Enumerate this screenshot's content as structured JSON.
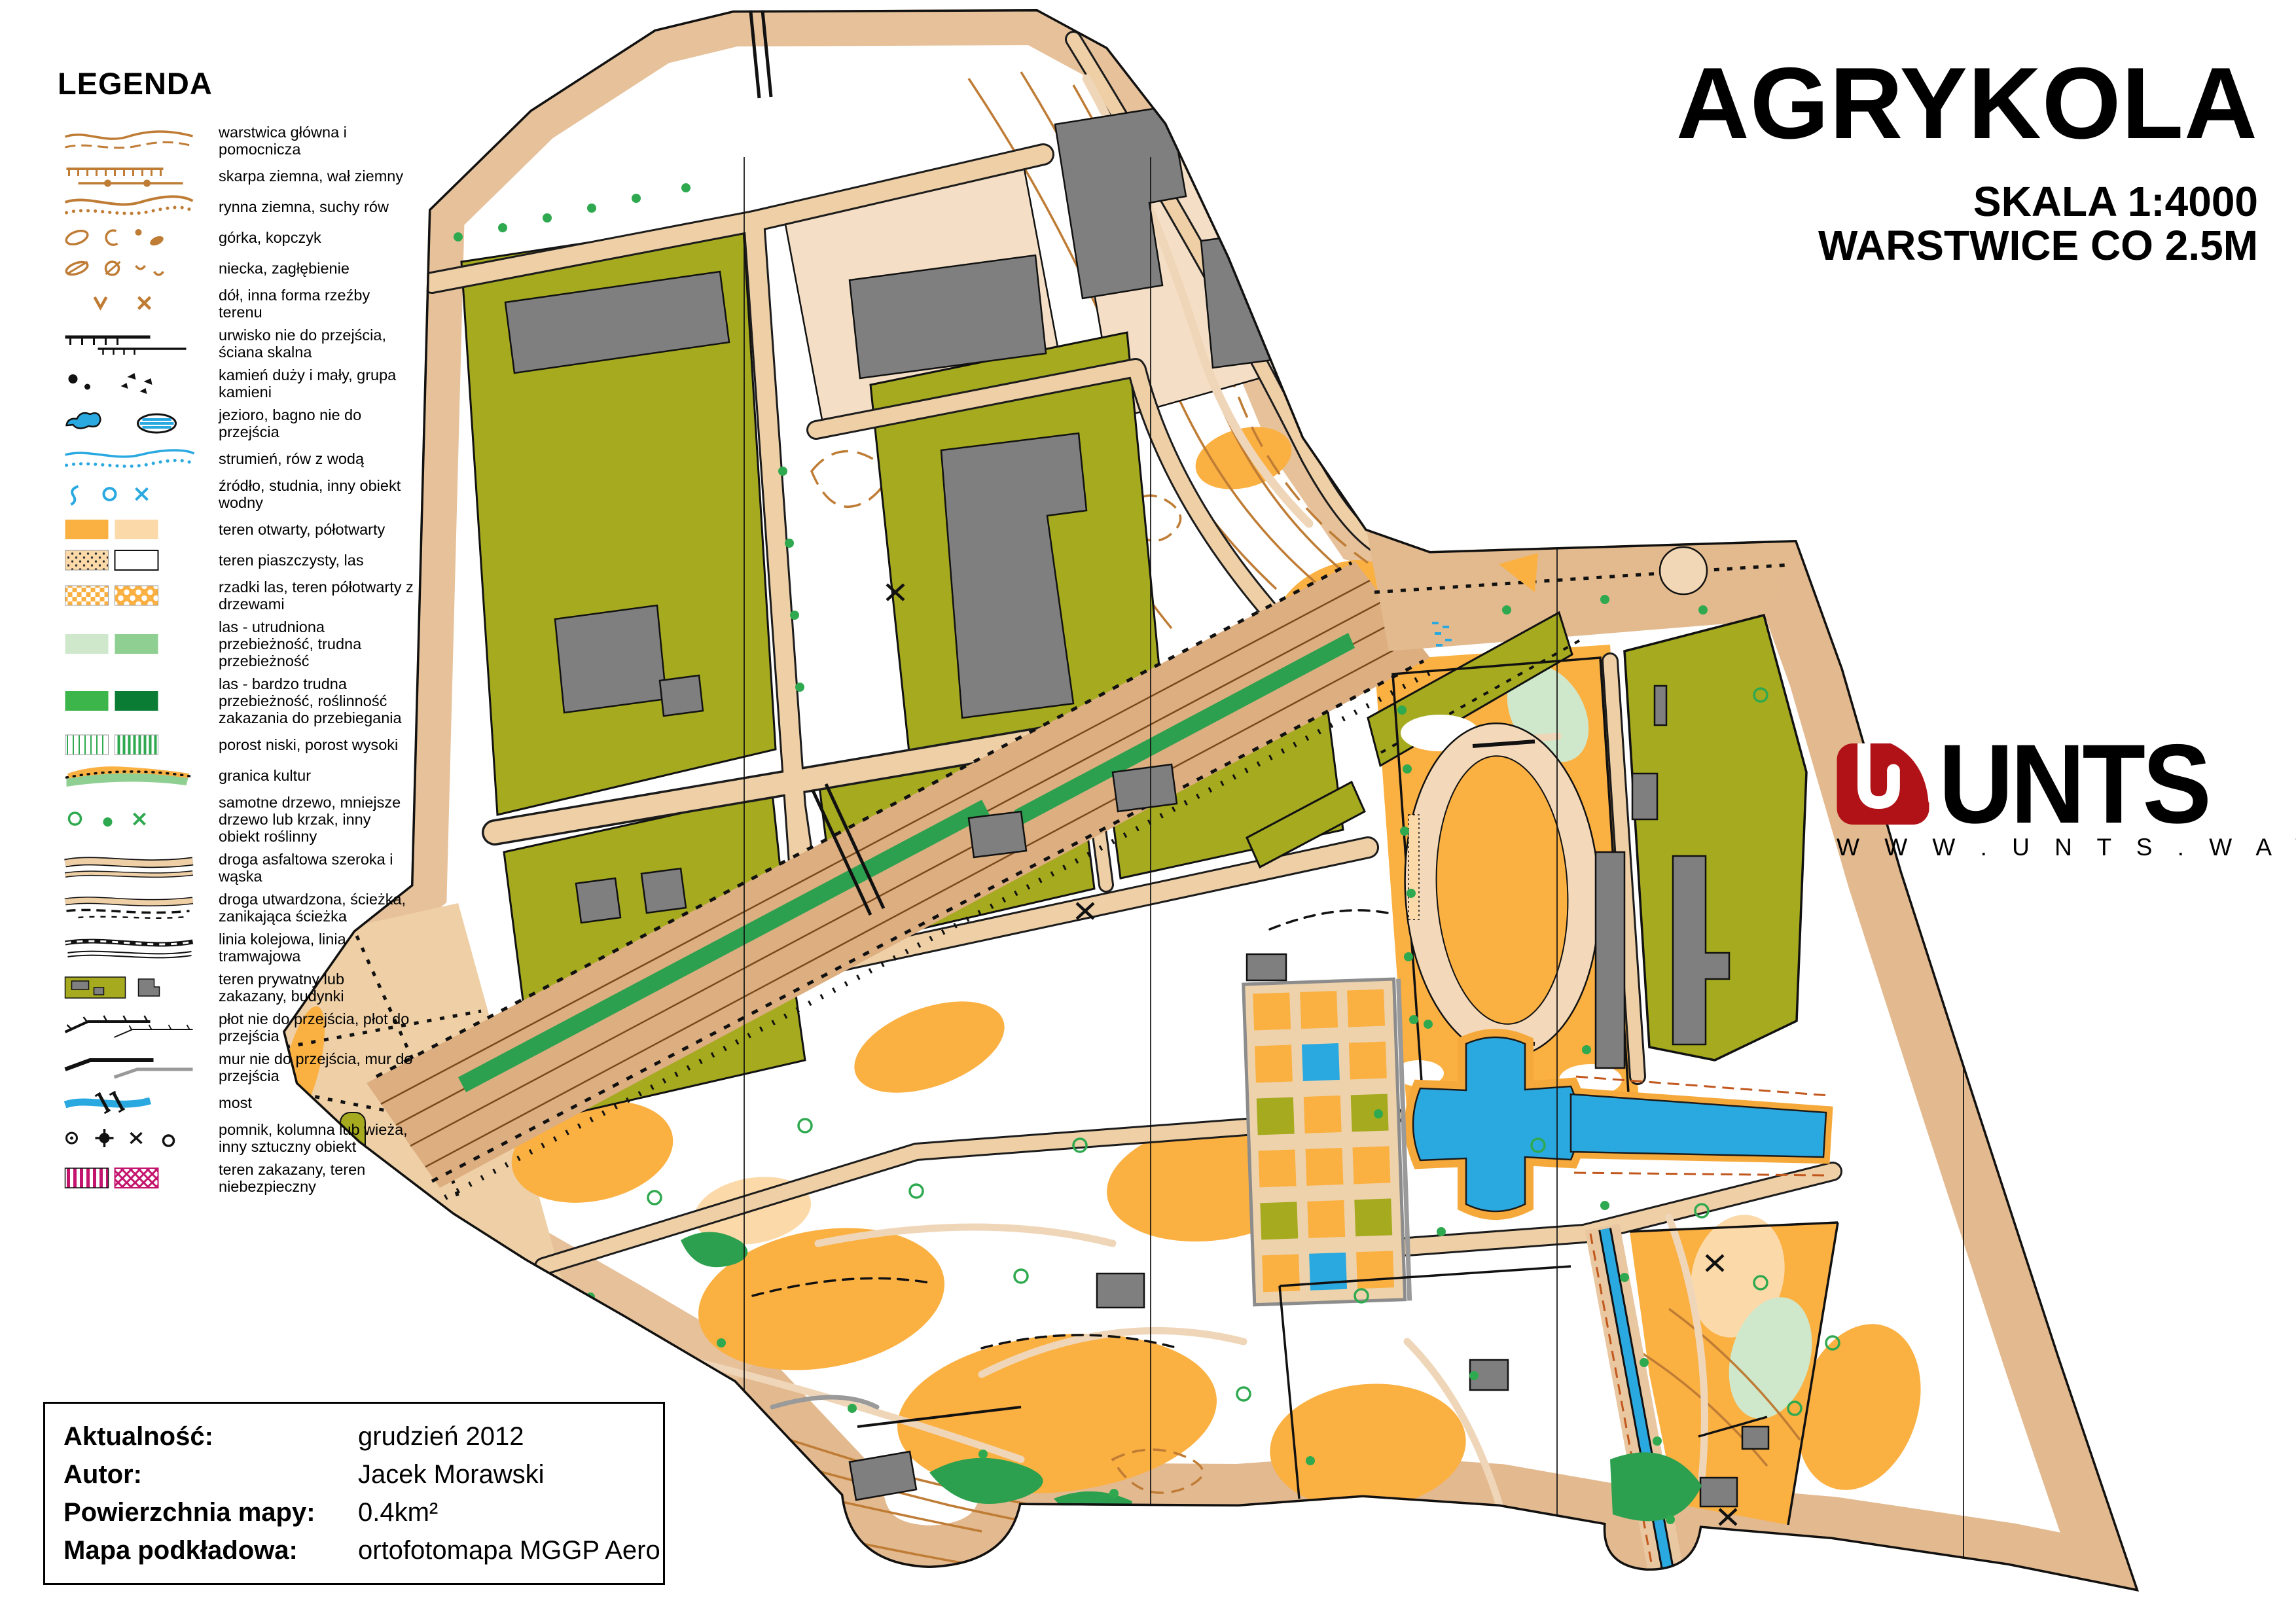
{
  "legend": {
    "title": "LEGENDA",
    "items": [
      {
        "symbol": "contours",
        "label": "warstwica główna i pomocnicza"
      },
      {
        "symbol": "earth-bank",
        "label": "skarpa ziemna, wał ziemny"
      },
      {
        "symbol": "dry-ditch",
        "label": "rynna ziemna, suchy rów"
      },
      {
        "symbol": "knoll",
        "label": "górka, kopczyk"
      },
      {
        "symbol": "depression",
        "label": "niecka, zagłębienie"
      },
      {
        "symbol": "pit",
        "label": "dół, inna forma rzeźby terenu"
      },
      {
        "symbol": "cliff",
        "label": "urwisko nie do przejścia, ściana skalna"
      },
      {
        "symbol": "stones",
        "label": "kamień duży i mały, grupa kamieni"
      },
      {
        "symbol": "lake-marsh",
        "label": "jezioro, bagno nie do przejścia"
      },
      {
        "symbol": "stream",
        "label": "strumień, rów z wodą"
      },
      {
        "symbol": "spring",
        "label": "źródło, studnia, inny obiekt wodny"
      },
      {
        "symbol": "open-land",
        "label": "teren otwarty, półotwarty"
      },
      {
        "symbol": "sand-forest",
        "label": "teren piaszczysty, las"
      },
      {
        "symbol": "rough-open",
        "label": "rzadki las, teren półotwarty z drzewami"
      },
      {
        "symbol": "forest-walk",
        "label": "las - utrudniona przebieżność, trudna przebieżność"
      },
      {
        "symbol": "forest-fight",
        "label": "las - bardzo trudna przebieżność, roślinność zakazania do przebiegania"
      },
      {
        "symbol": "undergrowth",
        "label": "porost niski, porost wysoki"
      },
      {
        "symbol": "cultivation-boundary",
        "label": "granica kultur"
      },
      {
        "symbol": "tree",
        "label": "samotne drzewo, mniejsze drzewo lub krzak, inny obiekt roślinny"
      },
      {
        "symbol": "paved-road",
        "label": "droga asfaltowa szeroka i wąska"
      },
      {
        "symbol": "footpath",
        "label": "droga utwardzona, ścieżka, zanikająca ścieżka"
      },
      {
        "symbol": "railway",
        "label": "linia kolejowa, linia tramwajowa"
      },
      {
        "symbol": "private-area",
        "label": "teren prywatny lub zakazany, budynki"
      },
      {
        "symbol": "fence",
        "label": "płot nie do przejścia, płot do przejścia"
      },
      {
        "symbol": "wall",
        "label": "mur nie do przejścia, mur do przejścia"
      },
      {
        "symbol": "bridge",
        "label": "most"
      },
      {
        "symbol": "monument",
        "label": "pomnik, kolumna lub wieża, inny sztuczny obiekt"
      },
      {
        "symbol": "forbidden-area",
        "label": "teren zakazany, teren niebezpieczny"
      }
    ]
  },
  "title_block": {
    "title": "AGRYKOLA",
    "scale": "SKALA 1:4000",
    "contours_note": "WARSTWICE CO 2.5M"
  },
  "logo": {
    "name": "UNTS",
    "url": "W W W . U N T S . W A W . P L"
  },
  "info_box": {
    "rows": [
      {
        "label": "Aktualność:",
        "value": "grudzień 2012"
      },
      {
        "label": "Autor:",
        "value": "Jacek Morawski"
      },
      {
        "label": "Powierzchnia mapy:",
        "value": "0.4km²"
      },
      {
        "label": "Mapa podkładowa:",
        "value": "ortofotomapa MGGP Aero"
      }
    ]
  },
  "palette": {
    "open_orange": "#fbb042",
    "half_open": "#fcd9a8",
    "road_tan": "#eecfa6",
    "corridor_tan": "#dcae80",
    "olive_private": "#a5aa1f",
    "building_gray": "#7f7f7f",
    "water_blue": "#2aa9e1",
    "vegetation_green": "#2fa94f",
    "light_green": "#cfe8cc",
    "dark_green": "#0a7c33",
    "contour_brown": "#bf7c35",
    "forbidden_magenta": "#c4156e",
    "logo_red": "#b01217"
  }
}
